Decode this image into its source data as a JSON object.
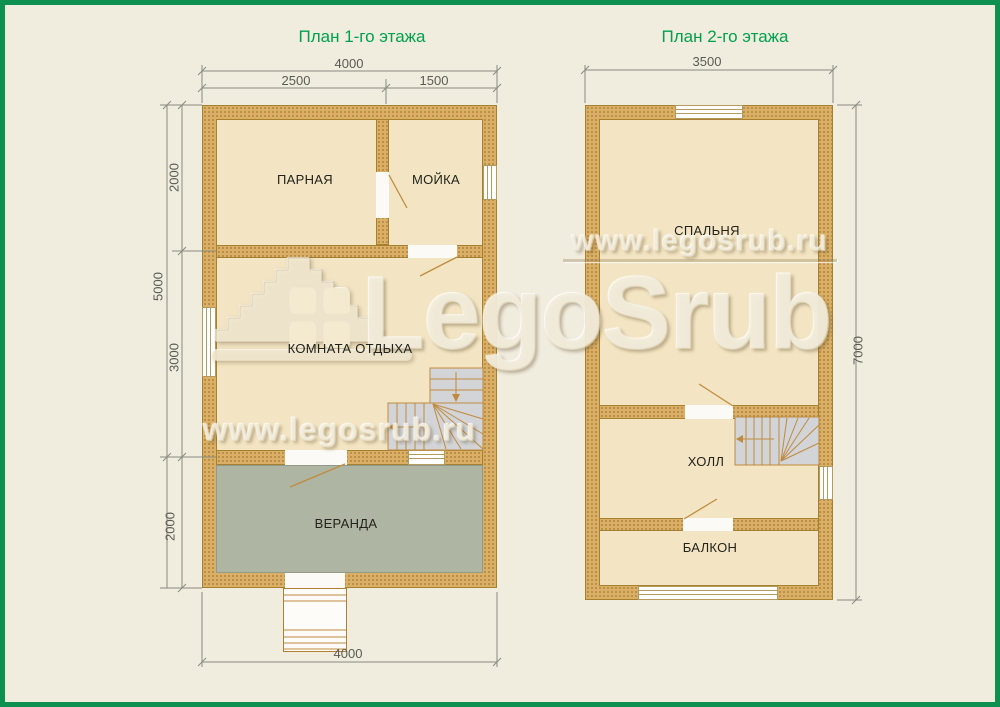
{
  "watermark": {
    "site": "www.legosrub.ru",
    "brand": "LegoSrub"
  },
  "plan1": {
    "title": "План 1-го этажа",
    "rooms": {
      "parnaya": "ПАРНАЯ",
      "moyka": "МОЙКА",
      "komnata": "КОМНАТА ОТДЫХА",
      "veranda": "ВЕРАНДА"
    },
    "dims": {
      "top_total": "4000",
      "top_left": "2500",
      "top_right": "1500",
      "side_total": "5000",
      "side_top": "2000",
      "side_mid": "3000",
      "side_bottom": "2000",
      "bottom": "4000"
    }
  },
  "plan2": {
    "title": "План 2-го этажа",
    "rooms": {
      "spalnya": "СПАЛЬНЯ",
      "holl": "ХОЛЛ",
      "balkon": "БАЛКОН"
    },
    "dims": {
      "top": "3500",
      "side": "7000"
    }
  },
  "colors": {
    "border_green": "#0E9150",
    "title_green": "#00A14D",
    "wall": "#DBB066",
    "room_floor": "#F3E5C3",
    "veranda_floor": "#AFB5A3",
    "stairs": "#D2D4D7",
    "stair_lines": "#C08A3E",
    "background": "#F0ECDE",
    "dimension_gray": "#8A8A80"
  }
}
